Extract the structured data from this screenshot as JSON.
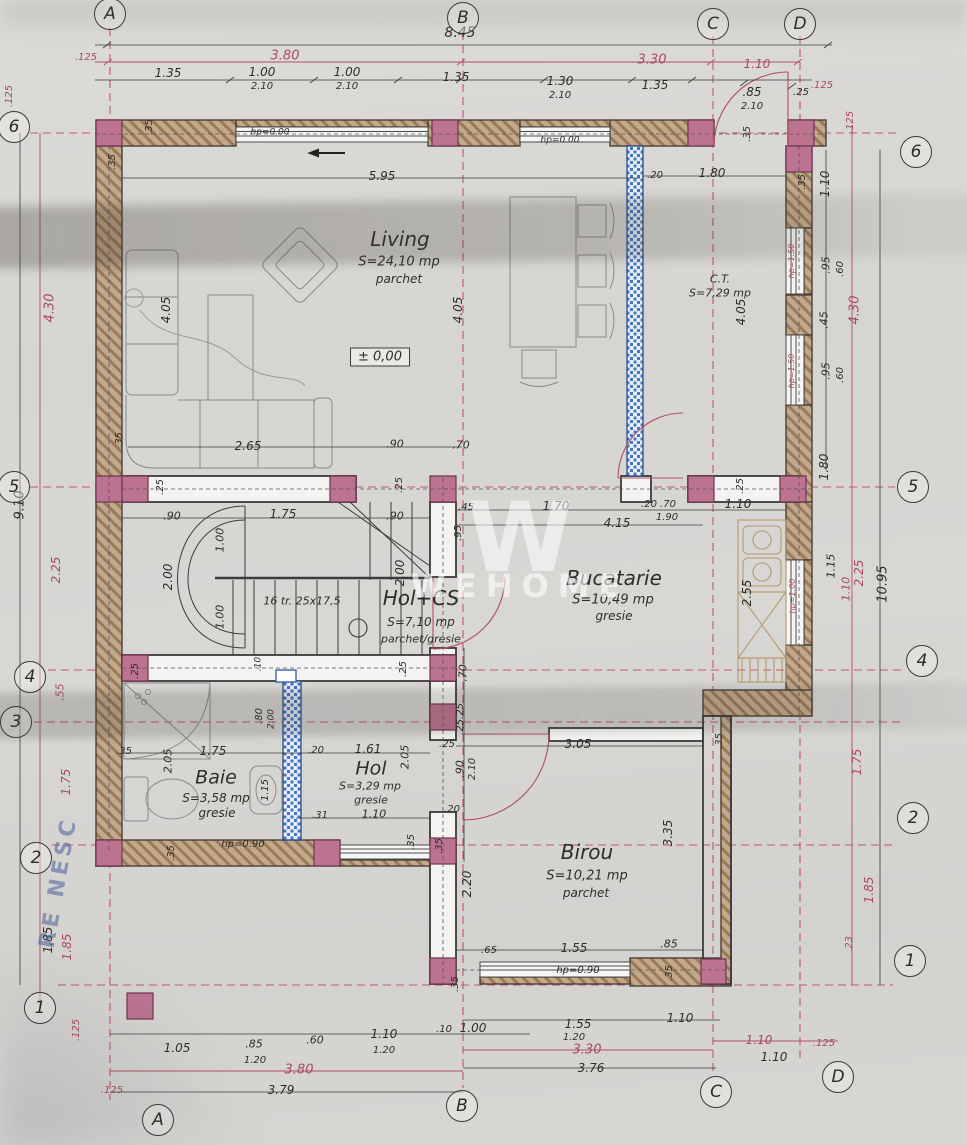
{
  "watermark": {
    "logo": "W",
    "text": "WEHOME"
  },
  "stamp": {
    "text": "RE NESC"
  },
  "grid": {
    "bubbles": [
      {
        "t": "A",
        "x": 110,
        "y": 14
      },
      {
        "t": "B",
        "x": 463,
        "y": 18
      },
      {
        "t": "C",
        "x": 713,
        "y": 24
      },
      {
        "t": "D",
        "x": 800,
        "y": 24
      },
      {
        "t": "A",
        "x": 158,
        "y": 1120
      },
      {
        "t": "B",
        "x": 462,
        "y": 1106
      },
      {
        "t": "C",
        "x": 716,
        "y": 1092
      },
      {
        "t": "D",
        "x": 838,
        "y": 1077
      },
      {
        "t": "6",
        "x": 14,
        "y": 127
      },
      {
        "t": "5",
        "x": 14,
        "y": 487
      },
      {
        "t": "4",
        "x": 30,
        "y": 677
      },
      {
        "t": "3",
        "x": 16,
        "y": 722
      },
      {
        "t": "2",
        "x": 36,
        "y": 858
      },
      {
        "t": "1",
        "x": 40,
        "y": 1008
      },
      {
        "t": "6",
        "x": 916,
        "y": 152
      },
      {
        "t": "5",
        "x": 913,
        "y": 487
      },
      {
        "t": "4",
        "x": 922,
        "y": 661
      },
      {
        "t": "2",
        "x": 913,
        "y": 818
      },
      {
        "t": "1",
        "x": 910,
        "y": 961
      }
    ]
  },
  "rooms_summary": [
    {
      "name": "Living",
      "area": "S=24,10 mp",
      "floor": "parchet"
    },
    {
      "name": "Bucatarie",
      "area": "S=10,49 mp",
      "floor": "gresie"
    },
    {
      "name": "Hol+CS",
      "area": "S=7,10 mp",
      "floor": "parchet/gresie"
    },
    {
      "name": "Baie",
      "area": "S=3,58 mp",
      "floor": "gresie"
    },
    {
      "name": "Hol",
      "area": "S=3,29 mp",
      "floor": "gresie"
    },
    {
      "name": "Birou",
      "area": "S=10,21 mp",
      "floor": "parchet"
    },
    {
      "name": "C.T.",
      "area": "S=7,29 mp",
      "floor": ""
    }
  ],
  "labels": [
    {
      "t": "8.45",
      "x": 460,
      "y": 33,
      "s": 14
    },
    {
      "t": "3.80",
      "x": 285,
      "y": 56,
      "c": "p",
      "s": 13
    },
    {
      "t": "3.30",
      "x": 652,
      "y": 60,
      "c": "p",
      "s": 13
    },
    {
      "t": "1.10",
      "x": 757,
      "y": 64,
      "c": "p",
      "s": 12
    },
    {
      "t": ".125",
      "x": 86,
      "y": 58,
      "c": "p",
      "s": 10
    },
    {
      "t": ".125",
      "x": 822,
      "y": 86,
      "c": "p",
      "s": 10
    },
    {
      "t": "1.35",
      "x": 168,
      "y": 73
    },
    {
      "t": "1.00",
      "x": 262,
      "y": 72
    },
    {
      "t": "2.10",
      "x": 262,
      "y": 87,
      "s": 10
    },
    {
      "t": "1.00",
      "x": 347,
      "y": 72
    },
    {
      "t": "2.10",
      "x": 347,
      "y": 87,
      "s": 10
    },
    {
      "t": "1.35",
      "x": 456,
      "y": 77
    },
    {
      "t": "1.30",
      "x": 560,
      "y": 81
    },
    {
      "t": "2.10",
      "x": 560,
      "y": 96,
      "s": 10
    },
    {
      "t": "1.35",
      "x": 655,
      "y": 85
    },
    {
      "t": ".85",
      "x": 752,
      "y": 92
    },
    {
      "t": "2.10",
      "x": 752,
      "y": 107,
      "s": 10
    },
    {
      "t": ".25",
      "x": 801,
      "y": 93,
      "s": 10
    },
    {
      "t": ".35",
      "x": 150,
      "y": 127,
      "r": -90,
      "s": 10
    },
    {
      "t": ".35",
      "x": 113,
      "y": 162,
      "r": -90,
      "s": 10
    },
    {
      "t": "hp=0.00",
      "x": 270,
      "y": 133,
      "s": 9
    },
    {
      "t": "hp=0.00",
      "x": 560,
      "y": 141,
      "s": 9
    },
    {
      "t": ".35",
      "x": 748,
      "y": 134,
      "r": -90,
      "s": 10
    },
    {
      "t": ".20",
      "x": 655,
      "y": 176,
      "s": 10
    },
    {
      "t": "1.80",
      "x": 712,
      "y": 173
    },
    {
      "t": "5.95",
      "x": 382,
      "y": 176
    },
    {
      "t": ".125",
      "x": 851,
      "y": 122,
      "r": -90,
      "c": "p",
      "s": 10
    },
    {
      "t": "1.10",
      "x": 825,
      "y": 184,
      "r": -90
    },
    {
      "t": ".35",
      "x": 803,
      "y": 182,
      "r": -90,
      "s": 10
    },
    {
      "t": "hp=1.50",
      "x": 792,
      "y": 261,
      "r": -90,
      "c": "p",
      "s": 8
    },
    {
      "t": ".95",
      "x": 826,
      "y": 265,
      "r": -90,
      "s": 11
    },
    {
      "t": ".60",
      "x": 841,
      "y": 269,
      "r": -90,
      "s": 10
    },
    {
      "t": ".45",
      "x": 824,
      "y": 320,
      "r": -90,
      "s": 11
    },
    {
      "t": "4.30",
      "x": 855,
      "y": 310,
      "r": -90,
      "c": "p",
      "s": 13
    },
    {
      "t": "hp=1.50",
      "x": 792,
      "y": 371,
      "r": -90,
      "c": "p",
      "s": 8
    },
    {
      "t": ".95",
      "x": 826,
      "y": 371,
      "r": -90,
      "s": 11
    },
    {
      "t": ".60",
      "x": 841,
      "y": 375,
      "r": -90,
      "s": 10
    },
    {
      "t": "1.80",
      "x": 824,
      "y": 467,
      "r": -90
    },
    {
      "t": "1.15",
      "x": 831,
      "y": 566,
      "r": -90,
      "s": 11
    },
    {
      "t": "1.10",
      "x": 846,
      "y": 589,
      "r": -90,
      "c": "p",
      "s": 11
    },
    {
      "t": "2.25",
      "x": 859,
      "y": 573,
      "r": -90,
      "c": "p",
      "s": 12
    },
    {
      "t": "10.95",
      "x": 883,
      "y": 584,
      "r": -90,
      "s": 13
    },
    {
      "t": "hp=1.00",
      "x": 793,
      "y": 596,
      "r": -90,
      "c": "p",
      "s": 8
    },
    {
      "t": "2.55",
      "x": 747,
      "y": 593,
      "r": -90
    },
    {
      "t": "1.75",
      "x": 857,
      "y": 762,
      "r": -90,
      "c": "p",
      "s": 12
    },
    {
      "t": "1.85",
      "x": 869,
      "y": 890,
      "r": -90,
      "c": "p",
      "s": 12
    },
    {
      "t": ".23",
      "x": 850,
      "y": 944,
      "r": -90,
      "c": "p",
      "s": 10
    },
    {
      "t": ".125",
      "x": 10,
      "y": 96,
      "r": -90,
      "c": "p",
      "s": 10
    },
    {
      "t": "4.30",
      "x": 50,
      "y": 308,
      "r": -90,
      "c": "p",
      "s": 13
    },
    {
      "t": "9.10",
      "x": 20,
      "y": 505,
      "r": -90,
      "s": 13
    },
    {
      "t": "2.25",
      "x": 56,
      "y": 570,
      "r": -90,
      "c": "p",
      "s": 12
    },
    {
      "t": ".55",
      "x": 60,
      "y": 692,
      "r": -90,
      "c": "p",
      "s": 11
    },
    {
      "t": "1.75",
      "x": 66,
      "y": 782,
      "r": -90,
      "c": "p",
      "s": 12
    },
    {
      "t": "1.85",
      "x": 48,
      "y": 940,
      "r": -90,
      "s": 12
    },
    {
      "t": "1.85",
      "x": 67,
      "y": 947,
      "r": -90,
      "c": "p",
      "s": 12
    },
    {
      "t": ".125",
      "x": 77,
      "y": 1030,
      "r": -90,
      "c": "p",
      "s": 10
    },
    {
      "t": "Living",
      "x": 400,
      "y": 239,
      "s": 20,
      "n": "room-name-living"
    },
    {
      "t": "S=24,10 mp",
      "x": 399,
      "y": 262,
      "s": 13,
      "n": "room-area-living"
    },
    {
      "t": "parchet",
      "x": 399,
      "y": 279,
      "s": 12,
      "n": "room-floor-living"
    },
    {
      "t": "± 0,00",
      "x": 380,
      "y": 357,
      "s": 13,
      "n": "level-mark",
      "f": "box"
    },
    {
      "t": "4.05",
      "x": 166,
      "y": 310,
      "r": -90
    },
    {
      "t": "4.05",
      "x": 458,
      "y": 310,
      "r": -90
    },
    {
      "t": "2.65",
      "x": 248,
      "y": 446
    },
    {
      "t": ".90",
      "x": 395,
      "y": 444,
      "s": 11
    },
    {
      "t": ".70",
      "x": 461,
      "y": 445,
      "s": 11
    },
    {
      "t": ".35",
      "x": 120,
      "y": 440,
      "r": -90,
      "s": 10
    },
    {
      "t": "C.T.",
      "x": 720,
      "y": 279,
      "s": 11,
      "n": "room-name-ct"
    },
    {
      "t": "S=7,29 mp",
      "x": 720,
      "y": 293,
      "s": 11,
      "n": "room-area-ct"
    },
    {
      "t": "4.05",
      "x": 741,
      "y": 312,
      "r": -90
    },
    {
      "t": ".25",
      "x": 161,
      "y": 487,
      "r": -90,
      "s": 10
    },
    {
      "t": ".25",
      "x": 400,
      "y": 485,
      "r": -90,
      "s": 10
    },
    {
      "t": ".45",
      "x": 466,
      "y": 508,
      "s": 10
    },
    {
      "t": "1.70",
      "x": 556,
      "y": 506
    },
    {
      "t": ".20",
      "x": 649,
      "y": 505,
      "s": 10
    },
    {
      "t": ".70",
      "x": 668,
      "y": 505,
      "s": 10
    },
    {
      "t": "1.10",
      "x": 738,
      "y": 504
    },
    {
      "t": "4.15",
      "x": 617,
      "y": 523
    },
    {
      "t": "1.90",
      "x": 667,
      "y": 518,
      "s": 10
    },
    {
      "t": ".25",
      "x": 741,
      "y": 486,
      "r": -90,
      "s": 10
    },
    {
      "t": ".95",
      "x": 459,
      "y": 533,
      "r": -90,
      "s": 10
    },
    {
      "t": ".90",
      "x": 172,
      "y": 516,
      "s": 11
    },
    {
      "t": "1.75",
      "x": 283,
      "y": 514
    },
    {
      "t": ".90",
      "x": 395,
      "y": 516,
      "s": 11
    },
    {
      "t": "1.00",
      "x": 220,
      "y": 540,
      "r": -90,
      "s": 11
    },
    {
      "t": "2.00",
      "x": 168,
      "y": 577,
      "r": -90
    },
    {
      "t": "1.00",
      "x": 220,
      "y": 617,
      "r": -90,
      "s": 11
    },
    {
      "t": "2.00",
      "x": 400,
      "y": 573,
      "r": -90
    },
    {
      "t": "16 tr. 25x17,5",
      "x": 302,
      "y": 601,
      "s": 11,
      "n": "stairs-note"
    },
    {
      "t": "Hol+CS",
      "x": 421,
      "y": 598,
      "s": 20,
      "n": "room-name-holcs"
    },
    {
      "t": "S=7,10 mp",
      "x": 421,
      "y": 622,
      "s": 12,
      "n": "room-area-holcs"
    },
    {
      "t": "parchet/gresie",
      "x": 421,
      "y": 639,
      "s": 11,
      "n": "room-floor-holcs"
    },
    {
      "t": ".25",
      "x": 136,
      "y": 671,
      "r": -90,
      "s": 10
    },
    {
      "t": ".25",
      "x": 404,
      "y": 669,
      "r": -90,
      "s": 10
    },
    {
      "t": ".10",
      "x": 259,
      "y": 664,
      "r": -90,
      "s": 9
    },
    {
      "t": ".70",
      "x": 463,
      "y": 673,
      "r": -90,
      "s": 11
    },
    {
      "t": ".25",
      "x": 461,
      "y": 711,
      "r": -90,
      "s": 10
    },
    {
      "t": ".25",
      "x": 461,
      "y": 727,
      "r": -90,
      "s": 10
    },
    {
      "t": ".25",
      "x": 447,
      "y": 745,
      "s": 10
    },
    {
      "t": ".90",
      "x": 460,
      "y": 769,
      "r": -90,
      "s": 11
    },
    {
      "t": "2.10",
      "x": 473,
      "y": 769,
      "r": -90,
      "s": 10
    },
    {
      "t": ".20",
      "x": 452,
      "y": 810,
      "s": 10
    },
    {
      "t": ".35",
      "x": 440,
      "y": 846,
      "r": -90,
      "s": 10
    },
    {
      "t": ".80",
      "x": 260,
      "y": 716,
      "r": -90,
      "s": 10
    },
    {
      "t": "2.00",
      "x": 272,
      "y": 719,
      "r": -90,
      "s": 9
    },
    {
      "t": ".35",
      "x": 124,
      "y": 752,
      "s": 10
    },
    {
      "t": "2.05",
      "x": 168,
      "y": 761,
      "r": -90,
      "s": 11
    },
    {
      "t": "1.75",
      "x": 213,
      "y": 751
    },
    {
      "t": "Baie",
      "x": 216,
      "y": 778,
      "s": 19,
      "n": "room-name-baie"
    },
    {
      "t": "S=3,58 mp",
      "x": 216,
      "y": 798,
      "s": 12,
      "n": "room-area-baie"
    },
    {
      "t": "gresie",
      "x": 217,
      "y": 813,
      "s": 12,
      "n": "room-floor-baie"
    },
    {
      "t": "1.15",
      "x": 266,
      "y": 790,
      "r": -90,
      "s": 10
    },
    {
      "t": ".20",
      "x": 316,
      "y": 751,
      "s": 10
    },
    {
      "t": "1.61",
      "x": 368,
      "y": 749
    },
    {
      "t": "2.05",
      "x": 405,
      "y": 757,
      "r": -90,
      "s": 11
    },
    {
      "t": "Hol",
      "x": 371,
      "y": 769,
      "s": 19,
      "n": "room-name-hol"
    },
    {
      "t": "S=3,29 mp",
      "x": 370,
      "y": 786,
      "s": 11,
      "n": "room-area-hol"
    },
    {
      "t": "gresie",
      "x": 371,
      "y": 800,
      "s": 11,
      "n": "room-floor-hol"
    },
    {
      "t": ".31",
      "x": 320,
      "y": 816,
      "s": 10
    },
    {
      "t": "1.10",
      "x": 374,
      "y": 814,
      "s": 11
    },
    {
      "t": "hp=0.90",
      "x": 243,
      "y": 845,
      "s": 10
    },
    {
      "t": ".35",
      "x": 172,
      "y": 853,
      "r": -90,
      "s": 10
    },
    {
      "t": ".35",
      "x": 412,
      "y": 842,
      "r": -90,
      "s": 10
    },
    {
      "t": "3.05",
      "x": 578,
      "y": 744
    },
    {
      "t": ".35",
      "x": 720,
      "y": 741,
      "r": -90,
      "s": 10
    },
    {
      "t": "2.20",
      "x": 467,
      "y": 884,
      "r": -90
    },
    {
      "t": "3.35",
      "x": 668,
      "y": 833,
      "r": -90
    },
    {
      "t": "Birou",
      "x": 587,
      "y": 852,
      "s": 20,
      "n": "room-name-birou"
    },
    {
      "t": "S=10,21 mp",
      "x": 587,
      "y": 876,
      "s": 13,
      "n": "room-area-birou"
    },
    {
      "t": "parchet",
      "x": 586,
      "y": 893,
      "s": 12,
      "n": "room-floor-birou"
    },
    {
      "t": ".65",
      "x": 489,
      "y": 951,
      "s": 10
    },
    {
      "t": "1.55",
      "x": 574,
      "y": 948
    },
    {
      "t": ".85",
      "x": 669,
      "y": 944,
      "s": 11
    },
    {
      "t": "hp=0.90",
      "x": 578,
      "y": 971,
      "s": 10
    },
    {
      "t": ".35",
      "x": 670,
      "y": 973,
      "r": -90,
      "s": 10
    },
    {
      "t": ".35",
      "x": 456,
      "y": 984,
      "r": -90,
      "s": 10
    },
    {
      "t": "Bucatarie",
      "x": 614,
      "y": 578,
      "s": 20,
      "n": "room-name-bucatarie"
    },
    {
      "t": "S=10,49 mp",
      "x": 613,
      "y": 600,
      "s": 13,
      "n": "room-area-bucatarie"
    },
    {
      "t": "gresie",
      "x": 614,
      "y": 616,
      "s": 12,
      "n": "room-floor-bucatarie"
    },
    {
      "t": ".10",
      "x": 444,
      "y": 1030,
      "s": 10
    },
    {
      "t": "1.00",
      "x": 473,
      "y": 1028
    },
    {
      "t": "1.05",
      "x": 177,
      "y": 1048
    },
    {
      "t": ".85",
      "x": 254,
      "y": 1044,
      "s": 11
    },
    {
      "t": "1.20",
      "x": 255,
      "y": 1061,
      "s": 10
    },
    {
      "t": ".60",
      "x": 315,
      "y": 1040,
      "s": 11
    },
    {
      "t": "1.10",
      "x": 384,
      "y": 1034
    },
    {
      "t": "1.20",
      "x": 384,
      "y": 1051,
      "s": 10
    },
    {
      "t": "3.80",
      "x": 299,
      "y": 1070,
      "c": "p",
      "s": 13
    },
    {
      "t": "3.79",
      "x": 281,
      "y": 1090
    },
    {
      "t": ".125",
      "x": 112,
      "y": 1091,
      "c": "p",
      "s": 10
    },
    {
      "t": "1.55",
      "x": 578,
      "y": 1024
    },
    {
      "t": "1.20",
      "x": 574,
      "y": 1038,
      "s": 10
    },
    {
      "t": "1.10",
      "x": 680,
      "y": 1018
    },
    {
      "t": "3.30",
      "x": 587,
      "y": 1050,
      "c": "p",
      "s": 13
    },
    {
      "t": "1.10",
      "x": 759,
      "y": 1040,
      "c": "p",
      "s": 12
    },
    {
      "t": ".125",
      "x": 824,
      "y": 1044,
      "c": "p",
      "s": 10
    },
    {
      "t": "1.10",
      "x": 774,
      "y": 1057
    },
    {
      "t": "3.76",
      "x": 591,
      "y": 1068
    }
  ]
}
